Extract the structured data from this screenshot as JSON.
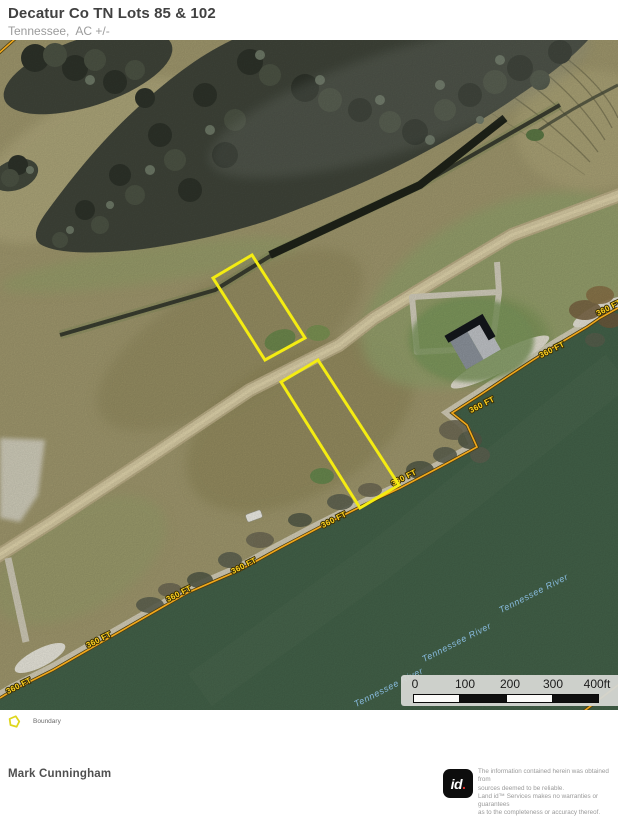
{
  "header": {
    "title": "Decatur Co TN Lots 85 & 102",
    "subtitle": "Tennessee,  AC +/-"
  },
  "map": {
    "contour_label": "360 FT",
    "river_label": "Tennessee River",
    "colors": {
      "boundary": "#f4ec12",
      "contour": "#f0a81c",
      "contour_text": "#ffd21e",
      "river_text": "#8cc0e6",
      "water": "#44634a",
      "field": "#a29a6f"
    }
  },
  "scale": {
    "ticks": [
      "0",
      "100",
      "200",
      "300",
      "400ft"
    ]
  },
  "legend": {
    "boundary_label": "Boundary"
  },
  "footer": {
    "author": "Mark Cunningham",
    "logo_text": "id",
    "logo_dot": ".",
    "disclaimer_lines": [
      "The information contained herein was obtained from",
      "sources deemed to be reliable.",
      " Land id™ Services makes no warranties or guarantees",
      "as to the completeness or accuracy thereof."
    ]
  }
}
